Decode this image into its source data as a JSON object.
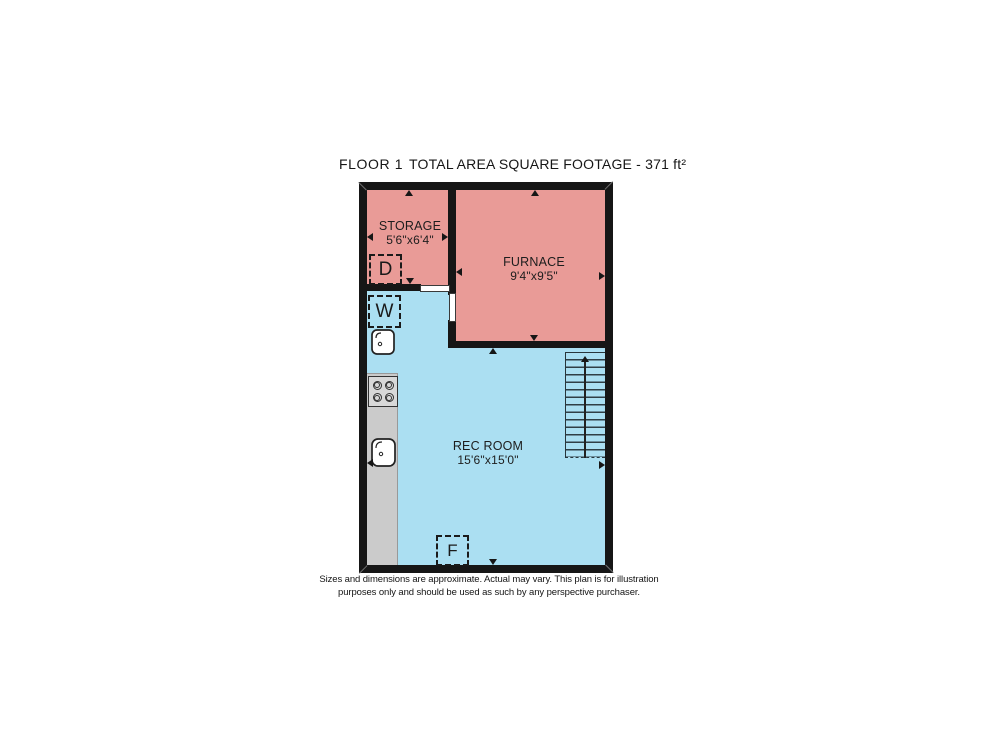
{
  "title": {
    "floor": "FLOOR 1",
    "area": "TOTAL AREA SQUARE FOOTAGE - 371 ft²"
  },
  "rooms": [
    {
      "name": "STORAGE",
      "dims": "5'6\"x6'4\""
    },
    {
      "name": "FURNACE",
      "dims": "9'4\"x9'5\""
    },
    {
      "name": "REC ROOM",
      "dims": "15'6\"x15'0\""
    }
  ],
  "units": {
    "dryer": "D",
    "washer": "W",
    "furnace": "F"
  },
  "icons": {
    "stove": "four-burner-cooktop",
    "sink": "sink-basin-with-faucet",
    "stairs": "staircase-going-up"
  },
  "disclaimer": {
    "line1": "Sizes and dimensions are approximate. Actual may vary. This plan is for illustration",
    "line2": "purposes only and should be used as such by any perspective purchaser."
  },
  "colors": {
    "room-warm": "#e99b97",
    "room-cool": "#abdff2",
    "wall": "#161616",
    "counter": "#cbcbcb"
  }
}
